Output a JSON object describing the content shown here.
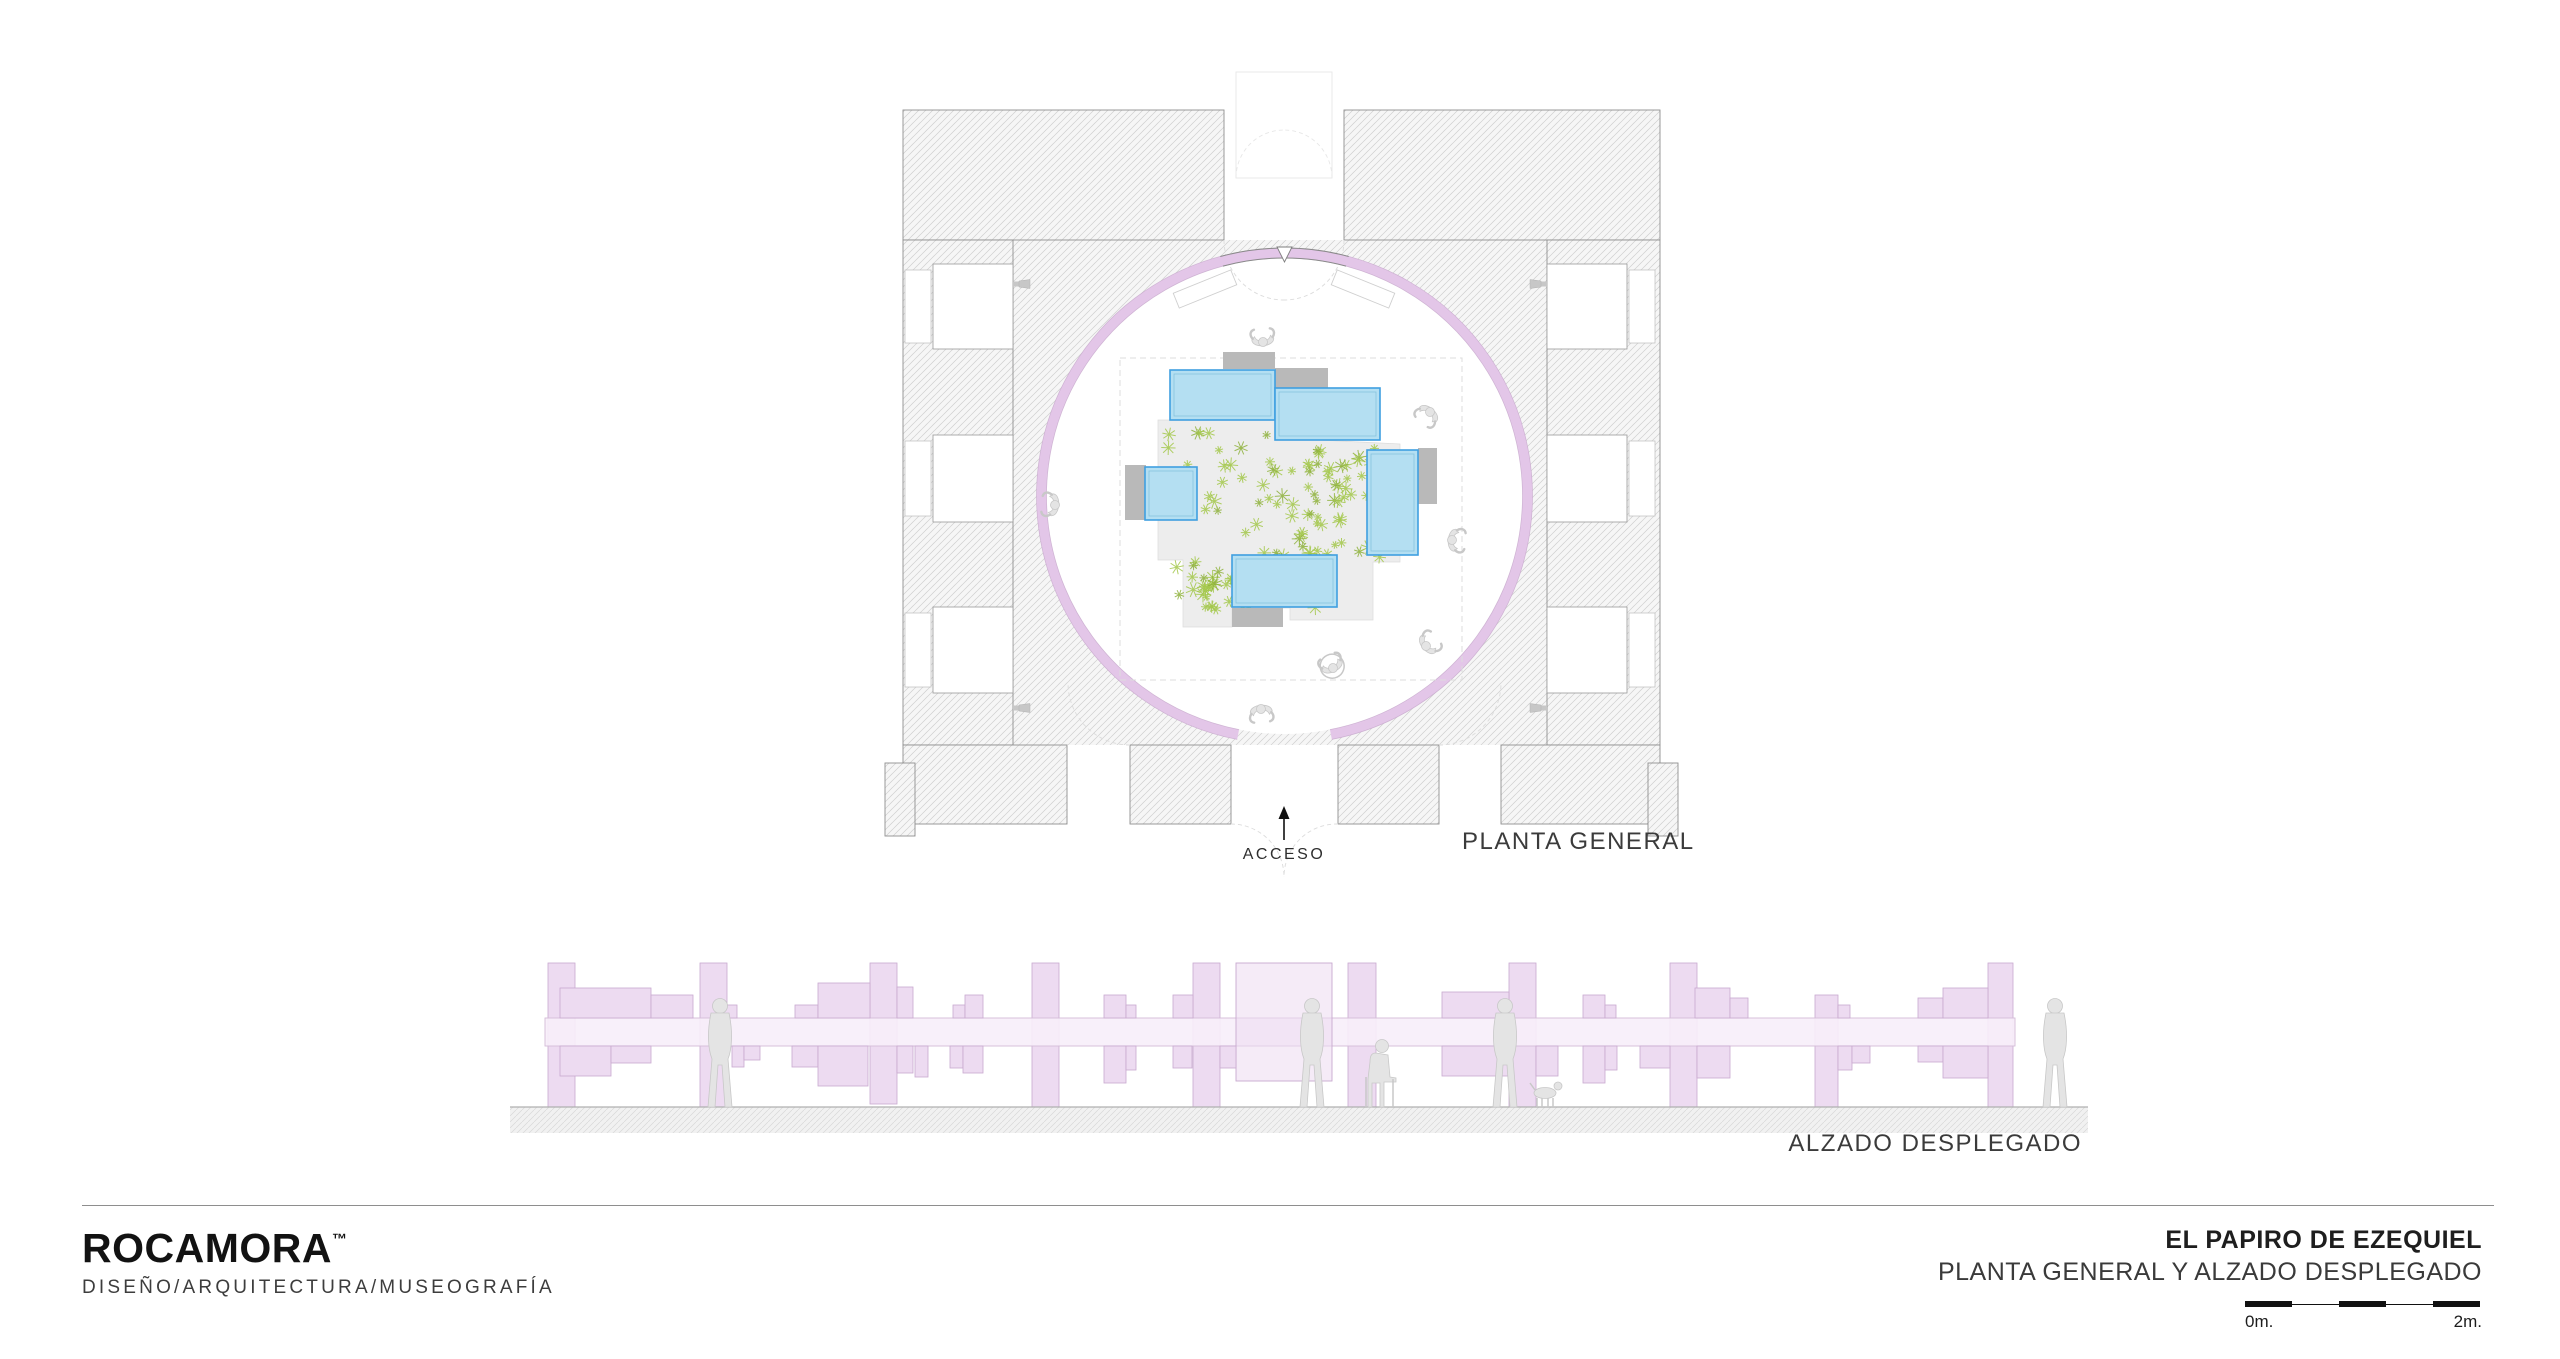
{
  "labels": {
    "acceso": "ACCESO",
    "planta_general": "PLANTA GENERAL",
    "alzado_desplegado": "ALZADO DESPLEGADO"
  },
  "footer": {
    "brand": "ROCAMORA",
    "trademark": "™",
    "tagline": "DISEÑO/ARQUITECTURA/MUSEOGRAFÍA",
    "project_title": "EL PAPIRO DE EZEQUIEL",
    "project_subtitle": "PLANTA GENERAL Y ALZADO DESPLEGADO",
    "scale_bar": {
      "start_label": "0m.",
      "end_label": "2m.",
      "segments": 5,
      "segment_px": 47
    }
  },
  "colors": {
    "ring": "#e3c6e8",
    "ring_edge": "#c7a9cc",
    "ring_dark_edge": "#8a8a8a",
    "wall_hatch_line": "#cfcfcf",
    "wall_fill": "#f6f6f6",
    "wall_outline": "#8f8f8f",
    "vitrine_fill": "#b4dff2",
    "vitrine_stroke": "#3f9fe0",
    "vitrine_inner": "#86c2dc",
    "plinth": "#b9b9b9",
    "platform": "#ededed",
    "platform_edge": "#dcdcdc",
    "plant_green": "#a4c84b",
    "plant_green_dark": "#8fb23c",
    "dashed_line": "#dcdcdc",
    "faint_line": "#e7e7e7",
    "person_fill": "#e4e4e4",
    "person_stroke": "#c8c8c8",
    "elev_panel_fill": "#eddbf1",
    "elev_panel_stroke": "#c8a9cf",
    "elev_band_fill": "#f7eef9",
    "elev_band_stroke": "#d3bcd8",
    "ground_line": "#b0b0b0",
    "ground_fill": "#f1f1f1",
    "arrow": "#111111"
  },
  "plan": {
    "ring": {
      "cx": 1284.5,
      "cy": 496,
      "r_mid": 243,
      "thickness": 10,
      "gap_half_deg": 11,
      "top_seg_half_deg": 15
    },
    "court": [
      1013,
      240,
      534,
      505
    ],
    "walls": [
      [
        903,
        110,
        321,
        130
      ],
      [
        1344,
        110,
        316,
        130
      ],
      [
        903,
        240,
        110,
        505
      ],
      [
        1547,
        240,
        113,
        505
      ],
      [
        903,
        745,
        164,
        79
      ],
      [
        1130,
        745,
        101,
        79
      ],
      [
        1338,
        745,
        101,
        79
      ],
      [
        1501,
        745,
        159,
        79
      ],
      [
        885,
        763,
        30,
        73
      ],
      [
        1648,
        763,
        30,
        73
      ]
    ],
    "niche_ys": [
      [
        264,
        85
      ],
      [
        435,
        87
      ],
      [
        607,
        86
      ]
    ],
    "dashed_square": [
      1120,
      358,
      342,
      322
    ],
    "platform": [
      [
        1158,
        420
      ],
      [
        1277,
        420
      ],
      [
        1277,
        438
      ],
      [
        1400,
        444
      ],
      [
        1400,
        562
      ],
      [
        1373,
        562
      ],
      [
        1373,
        620
      ],
      [
        1290,
        620
      ],
      [
        1290,
        608
      ],
      [
        1232,
        608
      ],
      [
        1232,
        627
      ],
      [
        1183,
        627
      ],
      [
        1183,
        560
      ],
      [
        1158,
        560
      ]
    ],
    "shadow_tri": [
      [
        1277,
        420
      ],
      [
        1380,
        440
      ],
      [
        1277,
        440
      ]
    ],
    "vitrines": [
      [
        1170,
        370,
        105,
        50
      ],
      [
        1275,
        388,
        105,
        52
      ],
      [
        1145,
        467,
        52,
        53
      ],
      [
        1367,
        450,
        51,
        105
      ],
      [
        1232,
        555,
        105,
        52
      ]
    ],
    "plinths": [
      [
        1223,
        352,
        52,
        17
      ],
      [
        1275,
        368,
        53,
        21
      ],
      [
        1125,
        465,
        21,
        55
      ],
      [
        1418,
        448,
        19,
        56
      ],
      [
        1232,
        608,
        51,
        19
      ]
    ],
    "benches": [
      [
        1205,
        289,
        -22
      ],
      [
        1363,
        289,
        22
      ]
    ],
    "people": [
      [
        1263,
        342,
        175,
        false
      ],
      [
        1430,
        412,
        40,
        false
      ],
      [
        1055,
        505,
        95,
        false
      ],
      [
        1452,
        540,
        -85,
        false
      ],
      [
        1426,
        646,
        -130,
        false
      ],
      [
        1333,
        668,
        155,
        true
      ],
      [
        1261,
        709,
        -5,
        false
      ]
    ],
    "spotlights": [
      [
        1022,
        284,
        0
      ],
      [
        1022,
        708,
        0
      ],
      [
        1538,
        284,
        180
      ],
      [
        1538,
        708,
        180
      ]
    ],
    "plants": {
      "count": 175,
      "areas": [
        [
          1168,
          428,
          160,
          185
        ],
        [
          1300,
          445,
          95,
          115
        ],
        [
          1200,
          555,
          125,
          58
        ]
      ]
    },
    "access_arrow_x": 1284
  },
  "elevation": {
    "band": [
      545,
      1018,
      1470,
      28
    ],
    "columns": [
      [
        548,
        963,
        27,
        144
      ],
      [
        700,
        963,
        27,
        144
      ],
      [
        870,
        963,
        27,
        141
      ],
      [
        1032,
        963,
        27,
        144
      ],
      [
        1193,
        963,
        27,
        144
      ],
      [
        1348,
        963,
        28,
        144
      ],
      [
        1509,
        963,
        27,
        144
      ],
      [
        1670,
        963,
        27,
        144
      ],
      [
        1815,
        995,
        23,
        112
      ],
      [
        1988,
        963,
        25,
        144
      ]
    ],
    "big_panel": [
      1236,
      963,
      96,
      118
    ],
    "panels_above": [
      [
        560,
        988,
        91,
        30
      ],
      [
        651,
        995,
        42,
        23
      ],
      [
        720,
        1005,
        17,
        13
      ],
      [
        795,
        1005,
        23,
        13
      ],
      [
        818,
        983,
        52,
        35
      ],
      [
        897,
        987,
        16,
        31
      ],
      [
        953,
        1005,
        12,
        13
      ],
      [
        965,
        995,
        18,
        23
      ],
      [
        1104,
        995,
        22,
        23
      ],
      [
        1126,
        1005,
        10,
        13
      ],
      [
        1173,
        995,
        20,
        23
      ],
      [
        1442,
        992,
        67,
        26
      ],
      [
        1583,
        995,
        22,
        23
      ],
      [
        1605,
        1005,
        11,
        13
      ],
      [
        1695,
        988,
        35,
        30
      ],
      [
        1730,
        998,
        18,
        20
      ],
      [
        1838,
        1005,
        12,
        13
      ],
      [
        1918,
        998,
        25,
        20
      ],
      [
        1943,
        988,
        45,
        30
      ]
    ],
    "panels_below": [
      [
        560,
        1046,
        51,
        30
      ],
      [
        611,
        1046,
        40,
        17
      ],
      [
        732,
        1046,
        12,
        21
      ],
      [
        744,
        1046,
        16,
        14
      ],
      [
        792,
        1046,
        26,
        21
      ],
      [
        818,
        1046,
        50,
        40
      ],
      [
        897,
        1046,
        16,
        27
      ],
      [
        915,
        1046,
        13,
        31
      ],
      [
        950,
        1046,
        13,
        22
      ],
      [
        963,
        1046,
        20,
        27
      ],
      [
        1104,
        1046,
        22,
        37
      ],
      [
        1126,
        1046,
        10,
        24
      ],
      [
        1173,
        1046,
        19,
        22
      ],
      [
        1220,
        1046,
        16,
        22
      ],
      [
        1442,
        1046,
        66,
        30
      ],
      [
        1536,
        1046,
        22,
        30
      ],
      [
        1583,
        1046,
        22,
        37
      ],
      [
        1605,
        1046,
        12,
        24
      ],
      [
        1640,
        1046,
        30,
        22
      ],
      [
        1697,
        1046,
        33,
        32
      ],
      [
        1838,
        1046,
        14,
        24
      ],
      [
        1852,
        1046,
        18,
        17
      ],
      [
        1918,
        1046,
        25,
        16
      ],
      [
        1943,
        1046,
        45,
        32
      ]
    ],
    "ground": {
      "line_y": 1107,
      "strip": [
        510,
        1107,
        1578,
        26
      ]
    },
    "figures": [
      [
        "standing",
        720
      ],
      [
        "walking",
        1312
      ],
      [
        "seated",
        1380
      ],
      [
        "walking",
        1505
      ],
      [
        "dog",
        1545
      ],
      [
        "standing",
        2055
      ]
    ]
  }
}
